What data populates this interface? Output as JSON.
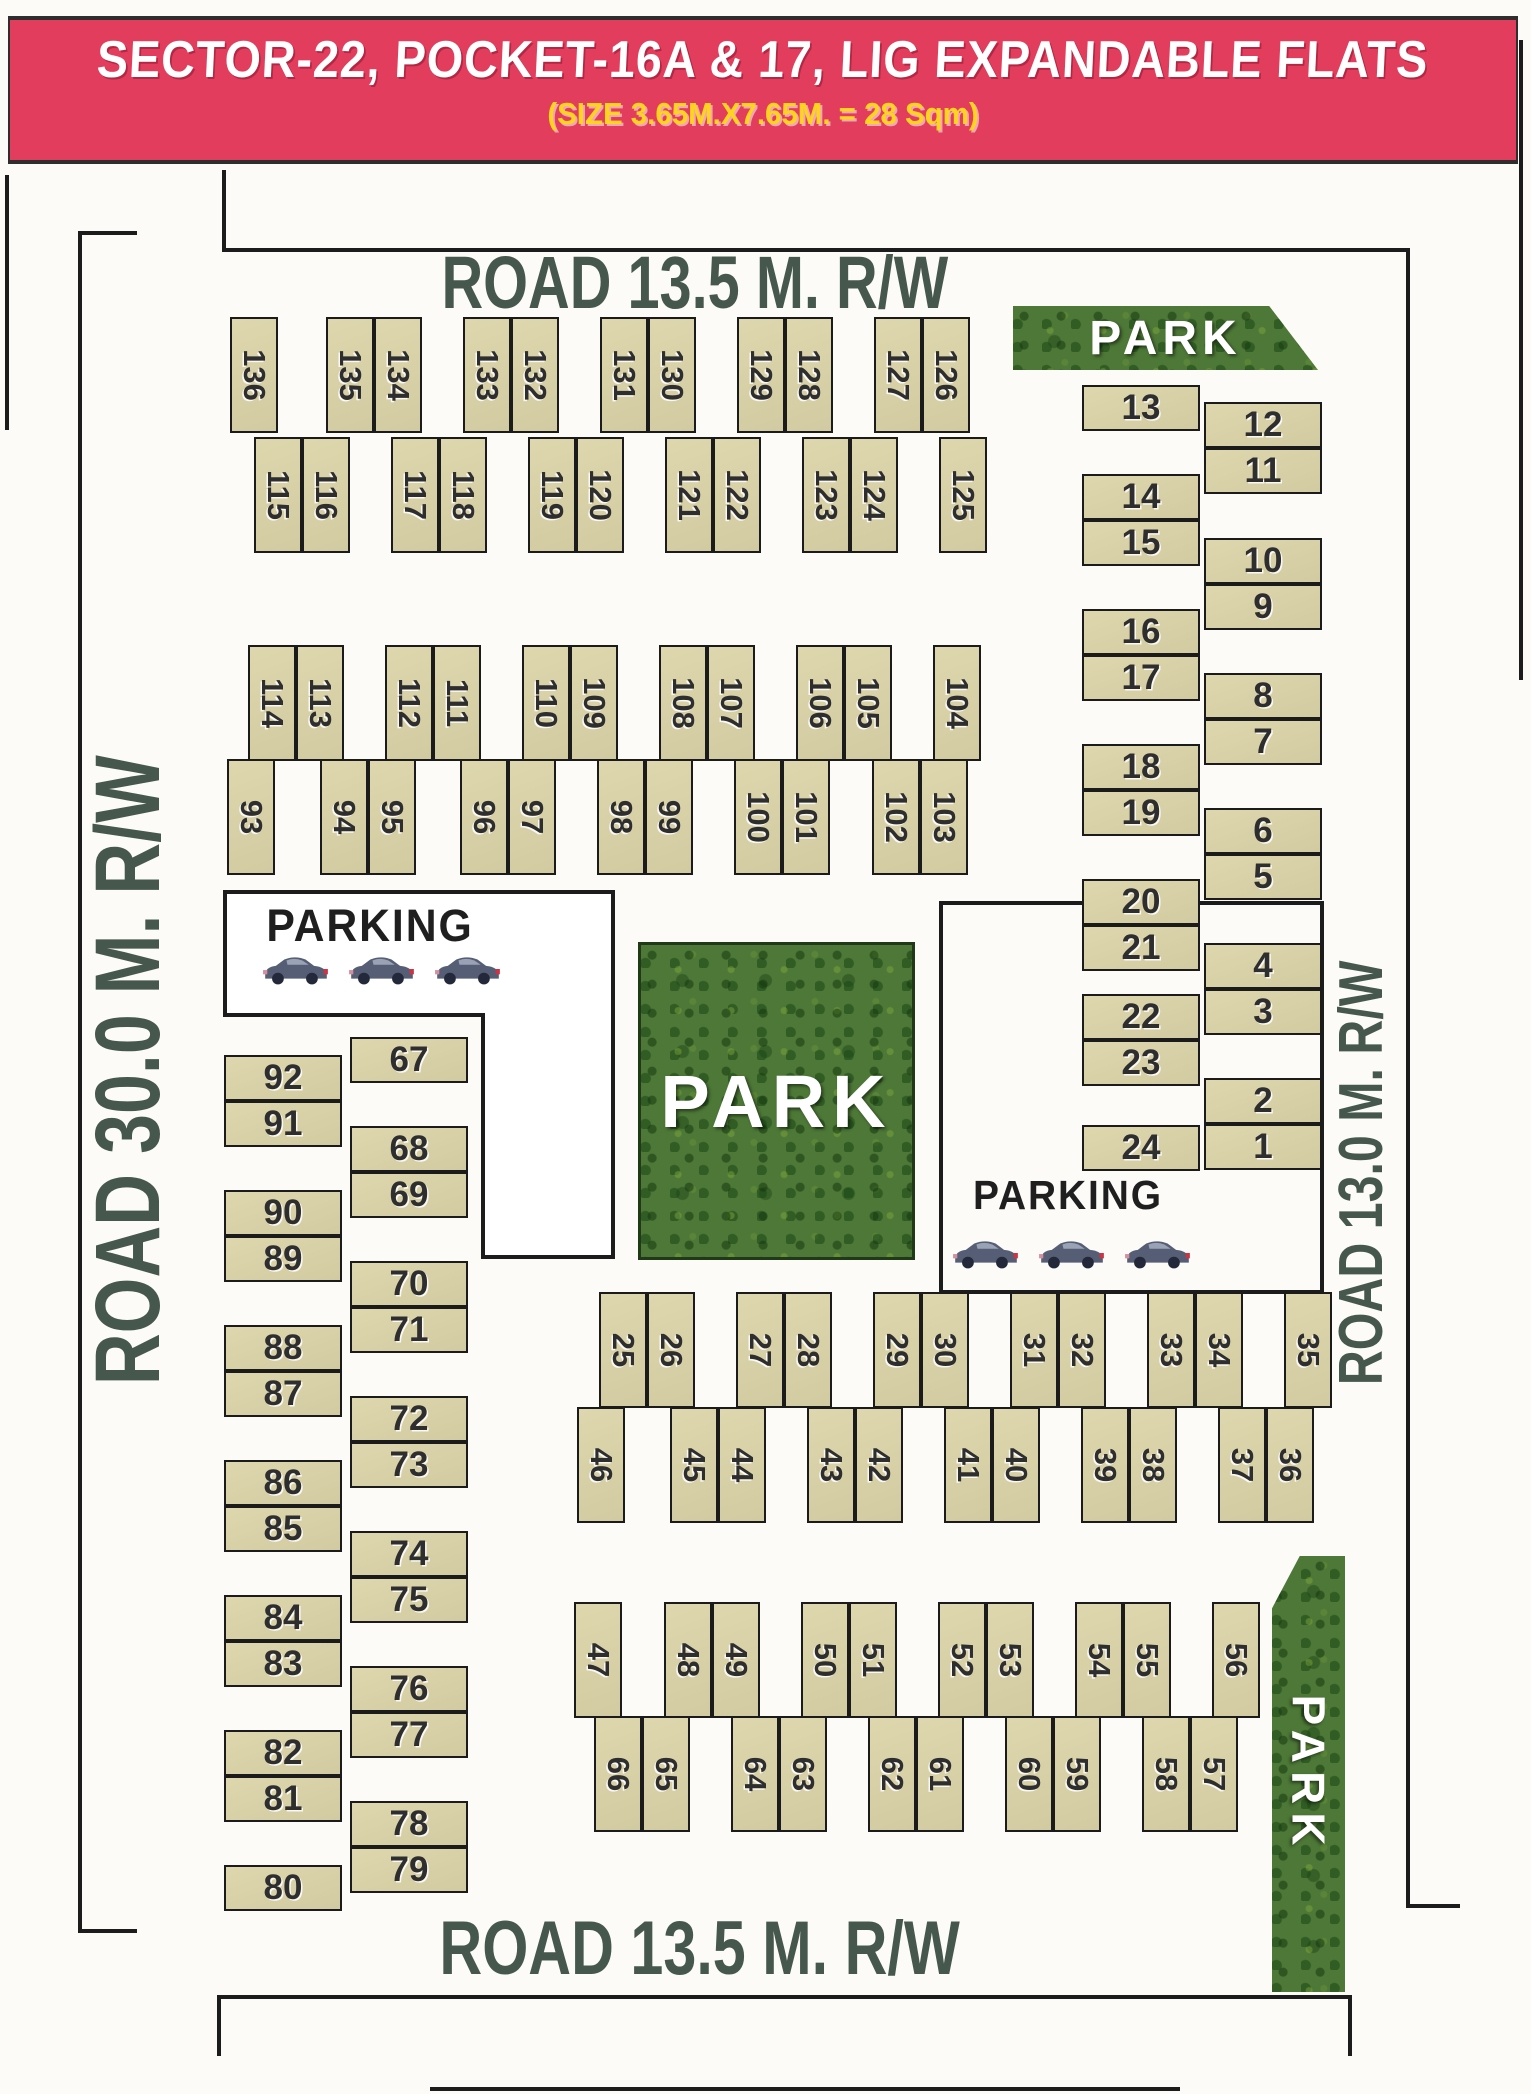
{
  "header": {
    "title": "SECTOR-22, POCKET-16A & 17, LIG EXPANDABLE FLATS",
    "subtitle": "(SIZE 3.65M.X7.65M. = 28 Sqm)"
  },
  "roads": {
    "top": "ROAD 13.5 M. R/W",
    "bottom": "ROAD 13.5 M. R/W",
    "left": "ROAD 30.0 M. R/W",
    "right": "ROAD 13.0 M. R/W"
  },
  "parks": {
    "top_right": "PARK",
    "center": "PARK",
    "bottom_right": "PARK"
  },
  "parking": {
    "left_label": "PARKING",
    "right_label": "PARKING",
    "car_icon": "car-icon"
  },
  "colors": {
    "header_bg": "#e23d5c",
    "header_title": "#ffffff",
    "header_subtitle": "#ffd41c",
    "plot_fill": "#d7cfa5",
    "plot_border": "#1b1b1b",
    "road_text": "#46584e",
    "park_green": "#4d7837",
    "line": "#1c1c1c"
  },
  "plot_blocks": [
    {
      "type": "v",
      "cell_w": 48,
      "cell_h": 116,
      "groups": [
        {
          "x": 230,
          "y": 317,
          "n": [
            "136"
          ]
        },
        {
          "x": 326,
          "y": 317,
          "n": [
            "135",
            "134"
          ]
        },
        {
          "x": 463,
          "y": 317,
          "n": [
            "133",
            "132"
          ]
        },
        {
          "x": 600,
          "y": 317,
          "n": [
            "131",
            "130"
          ]
        },
        {
          "x": 737,
          "y": 317,
          "n": [
            "129",
            "128"
          ]
        },
        {
          "x": 874,
          "y": 317,
          "n": [
            "127",
            "126"
          ]
        },
        {
          "x": 254,
          "y": 437,
          "n": [
            "115",
            "116"
          ]
        },
        {
          "x": 391,
          "y": 437,
          "n": [
            "117",
            "118"
          ]
        },
        {
          "x": 528,
          "y": 437,
          "n": [
            "119",
            "120"
          ]
        },
        {
          "x": 665,
          "y": 437,
          "n": [
            "121",
            "122"
          ]
        },
        {
          "x": 802,
          "y": 437,
          "n": [
            "123",
            "124"
          ]
        },
        {
          "x": 939,
          "y": 437,
          "n": [
            "125"
          ]
        },
        {
          "x": 248,
          "y": 645,
          "n": [
            "114",
            "113"
          ]
        },
        {
          "x": 385,
          "y": 645,
          "n": [
            "112",
            "111"
          ]
        },
        {
          "x": 522,
          "y": 645,
          "n": [
            "110",
            "109"
          ]
        },
        {
          "x": 659,
          "y": 645,
          "n": [
            "108",
            "107"
          ]
        },
        {
          "x": 796,
          "y": 645,
          "n": [
            "106",
            "105"
          ]
        },
        {
          "x": 933,
          "y": 645,
          "n": [
            "104"
          ]
        },
        {
          "x": 227,
          "y": 759,
          "n": [
            "93"
          ]
        },
        {
          "x": 320,
          "y": 759,
          "n": [
            "94",
            "95"
          ]
        },
        {
          "x": 460,
          "y": 759,
          "n": [
            "96",
            "97"
          ]
        },
        {
          "x": 597,
          "y": 759,
          "n": [
            "98",
            "99"
          ]
        },
        {
          "x": 734,
          "y": 759,
          "n": [
            "100",
            "101"
          ]
        },
        {
          "x": 872,
          "y": 759,
          "n": [
            "102",
            "103"
          ]
        },
        {
          "x": 599,
          "y": 1292,
          "n": [
            "25",
            "26"
          ]
        },
        {
          "x": 736,
          "y": 1292,
          "n": [
            "27",
            "28"
          ]
        },
        {
          "x": 873,
          "y": 1292,
          "n": [
            "29",
            "30"
          ]
        },
        {
          "x": 1010,
          "y": 1292,
          "n": [
            "31",
            "32"
          ]
        },
        {
          "x": 1147,
          "y": 1292,
          "n": [
            "33",
            "34"
          ]
        },
        {
          "x": 1284,
          "y": 1292,
          "n": [
            "35"
          ]
        },
        {
          "x": 577,
          "y": 1407,
          "n": [
            "46"
          ]
        },
        {
          "x": 670,
          "y": 1407,
          "n": [
            "45",
            "44"
          ]
        },
        {
          "x": 807,
          "y": 1407,
          "n": [
            "43",
            "42"
          ]
        },
        {
          "x": 944,
          "y": 1407,
          "n": [
            "41",
            "40"
          ]
        },
        {
          "x": 1081,
          "y": 1407,
          "n": [
            "39",
            "38"
          ]
        },
        {
          "x": 1218,
          "y": 1407,
          "n": [
            "37",
            "36"
          ]
        },
        {
          "x": 574,
          "y": 1602,
          "n": [
            "47"
          ]
        },
        {
          "x": 664,
          "y": 1602,
          "n": [
            "48",
            "49"
          ]
        },
        {
          "x": 801,
          "y": 1602,
          "n": [
            "50",
            "51"
          ]
        },
        {
          "x": 938,
          "y": 1602,
          "n": [
            "52",
            "53"
          ]
        },
        {
          "x": 1075,
          "y": 1602,
          "n": [
            "54",
            "55"
          ]
        },
        {
          "x": 1212,
          "y": 1602,
          "n": [
            "56"
          ]
        },
        {
          "x": 594,
          "y": 1716,
          "n": [
            "66",
            "65"
          ]
        },
        {
          "x": 731,
          "y": 1716,
          "n": [
            "64",
            "63"
          ]
        },
        {
          "x": 868,
          "y": 1716,
          "n": [
            "62",
            "61"
          ]
        },
        {
          "x": 1005,
          "y": 1716,
          "n": [
            "60",
            "59"
          ]
        },
        {
          "x": 1142,
          "y": 1716,
          "n": [
            "58",
            "57"
          ]
        }
      ]
    },
    {
      "type": "h",
      "cell_w": 118,
      "cell_h": 46,
      "groups": [
        {
          "x": 1082,
          "y": 385,
          "n": [
            "13"
          ]
        },
        {
          "x": 1082,
          "y": 474,
          "n": [
            "14",
            "15"
          ]
        },
        {
          "x": 1082,
          "y": 609,
          "n": [
            "16",
            "17"
          ]
        },
        {
          "x": 1082,
          "y": 744,
          "n": [
            "18",
            "19"
          ]
        },
        {
          "x": 1082,
          "y": 879,
          "n": [
            "20",
            "21"
          ]
        },
        {
          "x": 1082,
          "y": 994,
          "n": [
            "22",
            "23"
          ]
        },
        {
          "x": 1082,
          "y": 1125,
          "n": [
            "24"
          ]
        },
        {
          "x": 1204,
          "y": 402,
          "n": [
            "12",
            "11"
          ]
        },
        {
          "x": 1204,
          "y": 538,
          "n": [
            "10",
            "9"
          ]
        },
        {
          "x": 1204,
          "y": 673,
          "n": [
            "8",
            "7"
          ]
        },
        {
          "x": 1204,
          "y": 808,
          "n": [
            "6",
            "5"
          ]
        },
        {
          "x": 1204,
          "y": 943,
          "n": [
            "4",
            "3"
          ]
        },
        {
          "x": 1204,
          "y": 1078,
          "n": [
            "2",
            "1"
          ]
        },
        {
          "x": 224,
          "y": 1055,
          "n": [
            "92",
            "91"
          ]
        },
        {
          "x": 224,
          "y": 1190,
          "n": [
            "90",
            "89"
          ]
        },
        {
          "x": 224,
          "y": 1325,
          "n": [
            "88",
            "87"
          ]
        },
        {
          "x": 224,
          "y": 1460,
          "n": [
            "86",
            "85"
          ]
        },
        {
          "x": 224,
          "y": 1595,
          "n": [
            "84",
            "83"
          ]
        },
        {
          "x": 224,
          "y": 1730,
          "n": [
            "82",
            "81"
          ]
        },
        {
          "x": 224,
          "y": 1865,
          "n": [
            "80"
          ]
        },
        {
          "x": 350,
          "y": 1037,
          "n": [
            "67"
          ]
        },
        {
          "x": 350,
          "y": 1126,
          "n": [
            "68",
            "69"
          ]
        },
        {
          "x": 350,
          "y": 1261,
          "n": [
            "70",
            "71"
          ]
        },
        {
          "x": 350,
          "y": 1396,
          "n": [
            "72",
            "73"
          ]
        },
        {
          "x": 350,
          "y": 1531,
          "n": [
            "74",
            "75"
          ]
        },
        {
          "x": 350,
          "y": 1666,
          "n": [
            "76",
            "77"
          ]
        },
        {
          "x": 350,
          "y": 1801,
          "n": [
            "78",
            "79"
          ]
        }
      ]
    }
  ]
}
